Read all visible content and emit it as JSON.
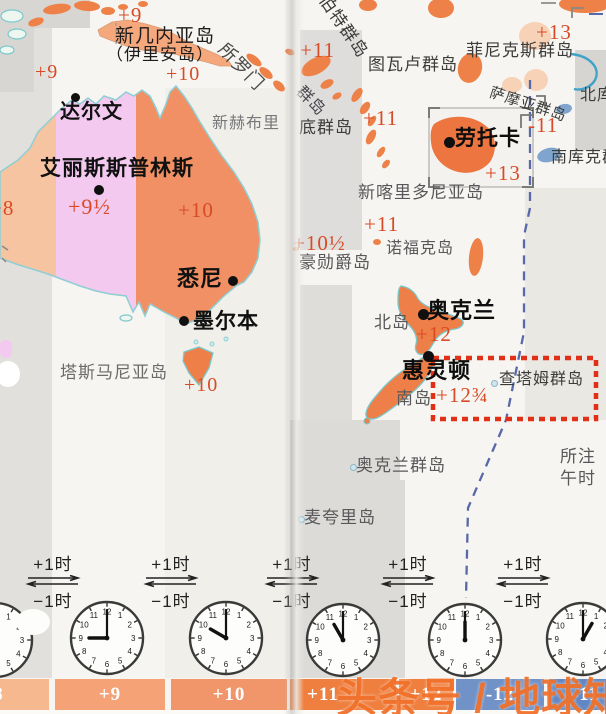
{
  "palette": {
    "red_label": "#d84b26",
    "land_salmon": "#f7c4a2",
    "land_lavender": "#f3c9ef",
    "land_orange": "#f19064",
    "island_orange": "#ee8147",
    "pale_peach": "#f8d2b6",
    "island_blue": "#7fa4cd",
    "coast_teal": "#7ac8cc",
    "date_line_blue": "#5868a8",
    "dashed_box_red": "#e23018",
    "bar_orange": "#ee7f3e",
    "bar_blue": "#6c90c6",
    "watermark_orange": "#f1722c"
  },
  "watermark": "头条号 / 地球知识局",
  "arrows": {
    "plus": "+1时",
    "minus": "−1时",
    "positions": [
      53,
      171,
      292,
      408,
      523
    ]
  },
  "clocks": [
    {
      "x": -5,
      "y": 640,
      "r": 37,
      "hour": 8
    },
    {
      "x": 107,
      "y": 638,
      "r": 36,
      "hour": 9
    },
    {
      "x": 226,
      "y": 638,
      "r": 36,
      "hour": 10
    },
    {
      "x": 343,
      "y": 640,
      "r": 36,
      "hour": 11
    },
    {
      "x": 465,
      "y": 640,
      "r": 36,
      "hour": 12
    },
    {
      "x": 583,
      "y": 639,
      "r": 36,
      "hour": 1
    }
  ],
  "zone_bar": {
    "y": 679,
    "h": 31,
    "segments": [
      {
        "label": "+8",
        "x": 0,
        "w": 49,
        "color": "#f6b88f",
        "dx": -32
      },
      {
        "label": "+9",
        "x": 55,
        "w": 110,
        "color": "#f4a276",
        "dx": 0
      },
      {
        "label": "+10",
        "x": 171,
        "w": 116,
        "color": "#f1966a",
        "dx": 0
      },
      {
        "label": "+11",
        "x": 290,
        "w": 106,
        "color": "#ee7f3e",
        "dx": -20
      },
      {
        "label": "+12",
        "x": 399,
        "w": 54,
        "color": "#ee7f3e",
        "dx": 0
      },
      {
        "label": "-12",
        "x": 456,
        "w": 88,
        "color": "#7192c7",
        "dx": 0
      },
      {
        "label": "-11",
        "x": 549,
        "w": 57,
        "color": "#6186c1",
        "dx": 8
      }
    ]
  },
  "labels": [
    {
      "t": "+9",
      "x": 118,
      "y": 5,
      "fs": 21,
      "c": "#d84b26"
    },
    {
      "t": "新几内亚岛",
      "x": 115,
      "y": 27,
      "fs": 19,
      "c": "#1c1c1c"
    },
    {
      "t": "（伊里安岛）",
      "x": 106,
      "y": 46,
      "fs": 17,
      "c": "#1c1c1c"
    },
    {
      "t": "所罗门",
      "x": 228,
      "y": 40,
      "fs": 18,
      "c": "#4a4a48",
      "rot": 46
    },
    {
      "t": "+9",
      "x": 35,
      "y": 62,
      "fs": 20,
      "c": "#d84b26"
    },
    {
      "t": "+10",
      "x": 166,
      "y": 64,
      "fs": 20,
      "c": "#d84b26"
    },
    {
      "t": "达尔文",
      "x": 60,
      "y": 102,
      "fs": 20,
      "c": "#111111",
      "b": 1
    },
    {
      "t": "新赫布里",
      "x": 212,
      "y": 116,
      "fs": 16,
      "c": "#77787a"
    },
    {
      "t": "艾丽斯斯普林斯",
      "x": 40,
      "y": 158,
      "fs": 21,
      "c": "#111111",
      "b": 1
    },
    {
      "t": "+8",
      "x": -10,
      "y": 198,
      "fs": 21,
      "c": "#d84b26"
    },
    {
      "t": "+9½",
      "x": 68,
      "y": 196,
      "fs": 22,
      "c": "#d84b26"
    },
    {
      "t": "+10",
      "x": 178,
      "y": 200,
      "fs": 21,
      "c": "#d84b26"
    },
    {
      "t": "悉尼",
      "x": 177,
      "y": 268,
      "fs": 22,
      "c": "#111111",
      "b": 1
    },
    {
      "t": "墨尔本",
      "x": 193,
      "y": 311,
      "fs": 21,
      "c": "#111111",
      "b": 1
    },
    {
      "t": "塔斯马尼亚岛",
      "x": 60,
      "y": 364,
      "fs": 17,
      "c": "#6b6b69"
    },
    {
      "t": "+10",
      "x": 184,
      "y": 375,
      "fs": 20,
      "c": "#d84b26"
    },
    {
      "t": "伯特群岛",
      "x": 330,
      "y": -8,
      "fs": 17,
      "c": "#3a3a38",
      "rot": 55
    },
    {
      "t": "+11",
      "x": 300,
      "y": 40,
      "fs": 21,
      "c": "#d84b26"
    },
    {
      "t": "图瓦卢群岛",
      "x": 368,
      "y": 56,
      "fs": 17,
      "c": "#3c3c3a"
    },
    {
      "t": "+13",
      "x": 536,
      "y": 22,
      "fs": 21,
      "c": "#d84b26"
    },
    {
      "t": "菲尼克斯群岛",
      "x": 466,
      "y": 42,
      "fs": 17,
      "c": "#3c3c3a"
    },
    {
      "t": "群岛",
      "x": 304,
      "y": 84,
      "fs": 16,
      "c": "#44444a",
      "rot": 45
    },
    {
      "t": "底群岛",
      "x": 299,
      "y": 119,
      "fs": 17,
      "c": "#3c3c3a"
    },
    {
      "t": "+11",
      "x": 363,
      "y": 108,
      "fs": 21,
      "c": "#d84b26"
    },
    {
      "t": "萨摩亚群岛",
      "x": 492,
      "y": 86,
      "fs": 15,
      "c": "#3c3c3a",
      "rot": 18
    },
    {
      "t": "北库克群岛",
      "x": 580,
      "y": 88,
      "fs": 16,
      "c": "#3c3c3a"
    },
    {
      "t": "-11",
      "x": 528,
      "y": 115,
      "fs": 21,
      "c": "#d84b26"
    },
    {
      "t": "劳托卡",
      "x": 455,
      "y": 128,
      "fs": 21,
      "c": "#0d0d0d",
      "b": 1
    },
    {
      "t": "南库克群岛",
      "x": 551,
      "y": 150,
      "fs": 16,
      "c": "#3c3c3a"
    },
    {
      "t": "+13",
      "x": 485,
      "y": 163,
      "fs": 21,
      "c": "#d84b26"
    },
    {
      "t": "新喀里多尼亚岛",
      "x": 358,
      "y": 184,
      "fs": 17,
      "c": "#58585a"
    },
    {
      "t": "+11",
      "x": 364,
      "y": 214,
      "fs": 21,
      "c": "#d84b26"
    },
    {
      "t": "+10½",
      "x": 293,
      "y": 233,
      "fs": 21,
      "c": "#d84b26"
    },
    {
      "t": "诺福克岛",
      "x": 386,
      "y": 241,
      "fs": 16,
      "c": "#58585a"
    },
    {
      "t": "豪勋爵岛",
      "x": 299,
      "y": 254,
      "fs": 17,
      "c": "#58585a"
    },
    {
      "t": "奥克兰",
      "x": 427,
      "y": 300,
      "fs": 22,
      "c": "#0d0d0d",
      "b": 1
    },
    {
      "t": "北岛",
      "x": 374,
      "y": 314,
      "fs": 17,
      "c": "#58585a"
    },
    {
      "t": "+12",
      "x": 416,
      "y": 324,
      "fs": 21,
      "c": "#d84b26"
    },
    {
      "t": "惠灵顿",
      "x": 402,
      "y": 360,
      "fs": 22,
      "c": "#0d0d0d",
      "b": 1
    },
    {
      "t": "查塔姆群岛",
      "x": 499,
      "y": 372,
      "fs": 16,
      "c": "#3c3c3a"
    },
    {
      "t": "南岛",
      "x": 396,
      "y": 390,
      "fs": 17,
      "c": "#58585a"
    },
    {
      "t": "+12¾",
      "x": 436,
      "y": 385,
      "fs": 21,
      "c": "#d84b26"
    },
    {
      "t": "奥克兰群岛",
      "x": 356,
      "y": 457,
      "fs": 17,
      "c": "#58585a"
    },
    {
      "t": "麦夸里岛",
      "x": 304,
      "y": 509,
      "fs": 17,
      "c": "#58585a"
    },
    {
      "t": "所注",
      "x": 560,
      "y": 448,
      "fs": 17,
      "c": "#58585a"
    },
    {
      "t": "午时",
      "x": 560,
      "y": 470,
      "fs": 17,
      "c": "#58585a"
    }
  ],
  "city_dots": [
    {
      "x": 75,
      "y": 97,
      "r": 4.5
    },
    {
      "x": 99,
      "y": 190,
      "r": 5
    },
    {
      "x": 233,
      "y": 281,
      "r": 5
    },
    {
      "x": 184,
      "y": 321,
      "r": 5
    },
    {
      "x": 449,
      "y": 142,
      "r": 5.5
    },
    {
      "x": 423,
      "y": 314,
      "r": 5.5
    },
    {
      "x": 428,
      "y": 356,
      "r": 5.5
    }
  ],
  "island_markers": [
    {
      "x": 350,
      "y": 464
    },
    {
      "x": 298,
      "y": 516
    },
    {
      "x": 491,
      "y": 380
    }
  ]
}
